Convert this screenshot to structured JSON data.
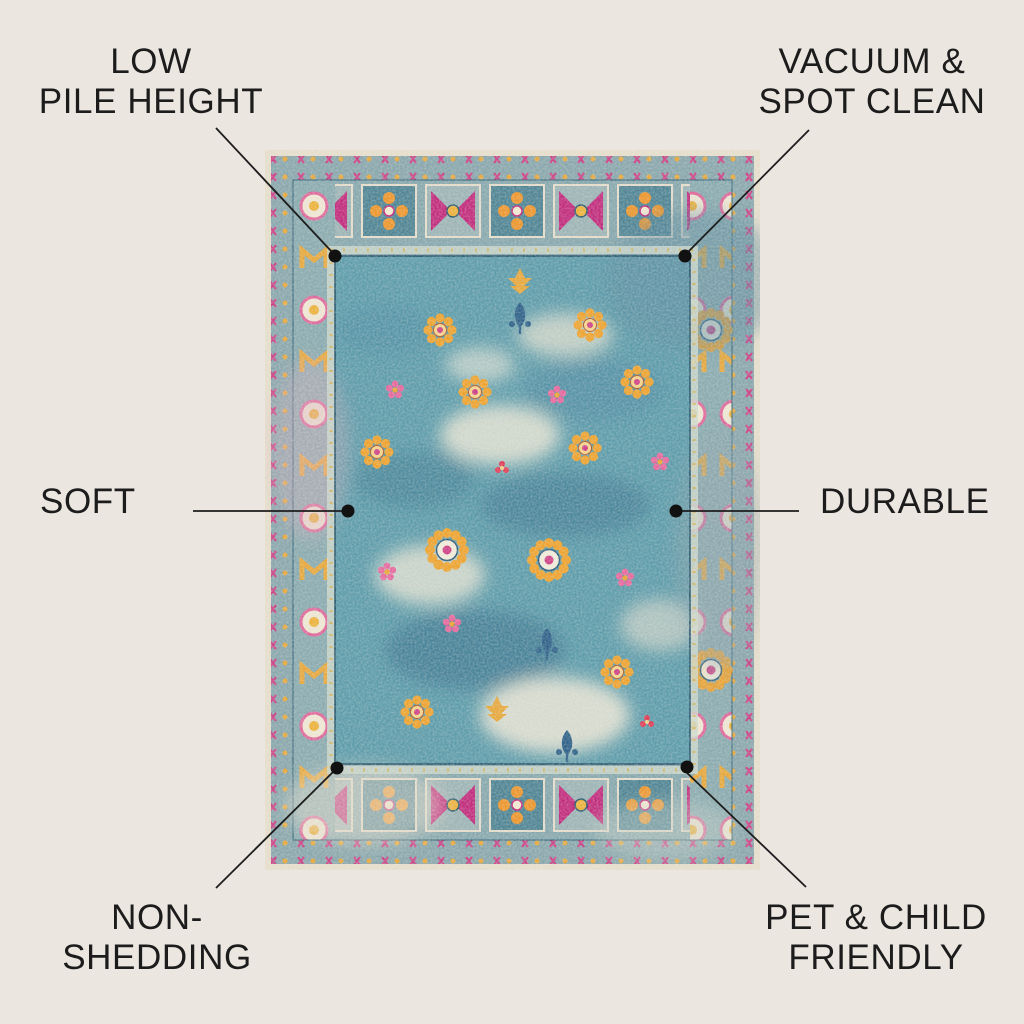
{
  "colors": {
    "bg": "#ece6e1",
    "text": "#1c1c1c",
    "line": "#1d1d1d",
    "dot": "#111111",
    "rug-ivory": "#e7dfcd",
    "rug-border-base": "#89a7ad",
    "rug-field": "#5d9cab",
    "rug-navy": "#1f4e66",
    "rug-magenta": "#c22a7c",
    "rug-orange": "#ee962c",
    "rug-gold": "#e8a83c",
    "rug-pink": "#e8679e",
    "rug-red": "#e23b55",
    "rug-cream": "#efe8d6"
  },
  "labels": {
    "top_left": "LOW\nPILE HEIGHT",
    "top_right": "VACUUM &\nSPOT CLEAN",
    "mid_left": "SOFT",
    "mid_right": "DURABLE",
    "bottom_left": "NON-\nSHEDDING",
    "bottom_right": "PET & CHILD\nFRIENDLY"
  }
}
